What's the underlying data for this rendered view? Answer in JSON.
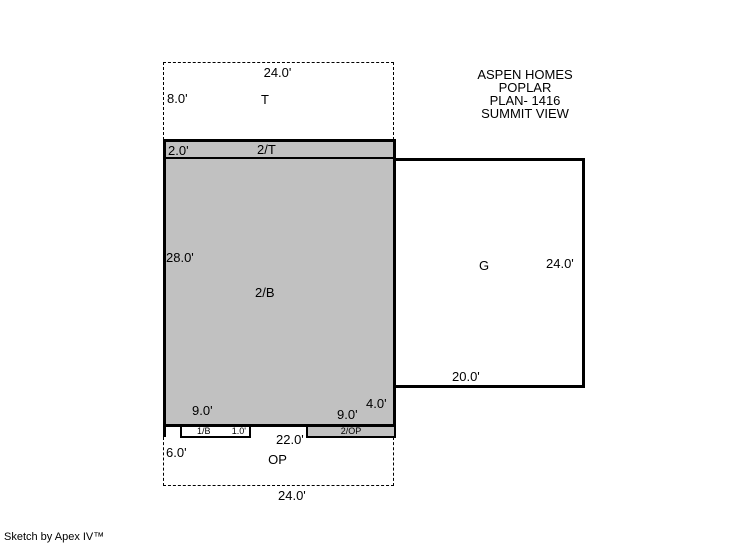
{
  "title_block": {
    "line1": "ASPEN HOMES",
    "line2": "POPLAR",
    "line3": "PLAN- 1416",
    "line4": "SUMMIT VIEW"
  },
  "footer": {
    "credit": "Sketch by Apex IV™"
  },
  "colors": {
    "area_fill_gray": "#c1c1c1",
    "line_black": "#000000",
    "background": "#ffffff"
  },
  "areas": {
    "attic": {
      "name": "T",
      "top_width": "24.0'",
      "left_height": "8.0'"
    },
    "upper_band": {
      "name": "2/T",
      "left_height": "2.0'"
    },
    "main": {
      "name": "2/B",
      "left_height": "28.0'"
    },
    "garage": {
      "name": "G",
      "right_height": "24.0'",
      "bottom_width": "20.0'"
    },
    "porch": {
      "name": "OP",
      "left_height": "6.0'",
      "top_width": "22.0'",
      "bottom_width": "24.0'"
    },
    "strip_1b": {
      "name": "1/B",
      "depth": "1.0'"
    },
    "strip_2op": {
      "name": "2/OP"
    }
  },
  "dimensions": {
    "bottom_left": "9.0'",
    "bottom_right": "9.0'",
    "right_step": "4.0'"
  }
}
